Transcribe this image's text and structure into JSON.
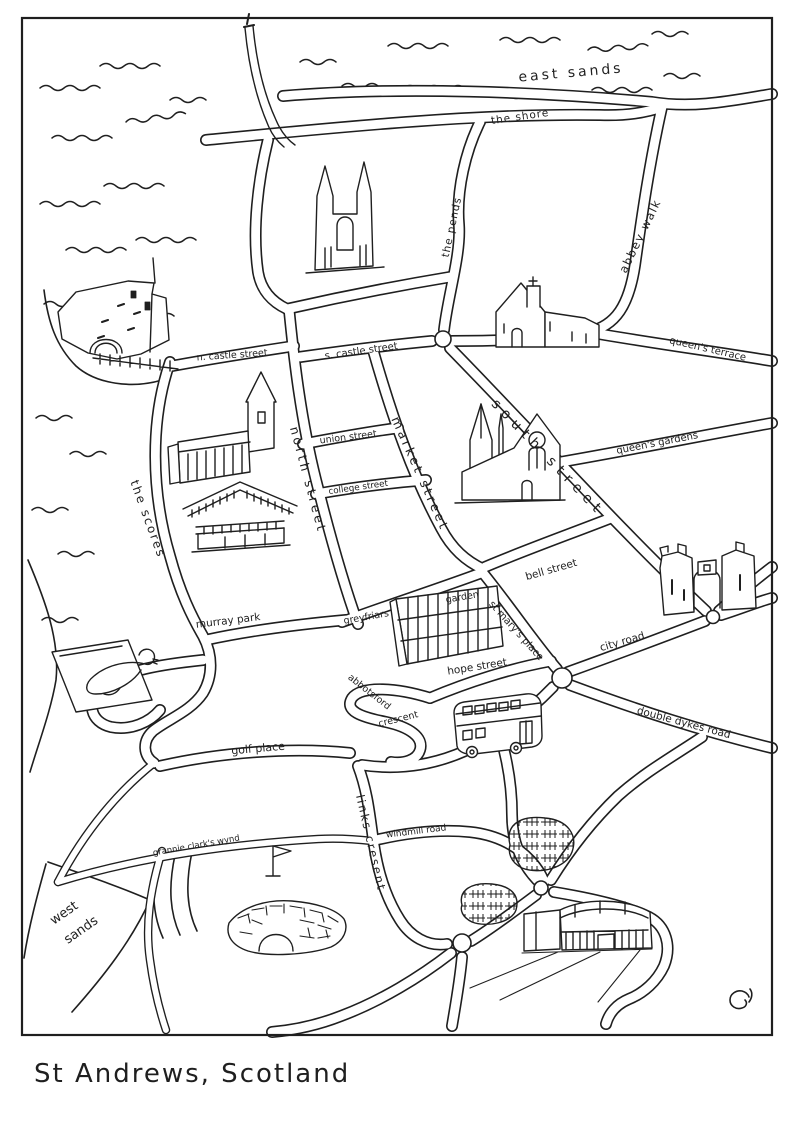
{
  "title": "St Andrews, Scotland",
  "colors": {
    "ink": "#1f1f1f",
    "paper": "#ffffff"
  },
  "map": {
    "water_labels": {
      "east_sands": "east sands",
      "west_sands_word1": "west",
      "west_sands_word2": "sands"
    },
    "streets": {
      "the_shore": "the shore",
      "the_pends": "the pends",
      "abbey_walk": "abbey walk",
      "queens_terrace": "queen's terrace",
      "n_castle_street": "n. castle street",
      "s_castle_street": "s. castle street",
      "south_street": "south street",
      "union_street": "union street",
      "market_street": "market street",
      "north_street": "north street",
      "college_street": "college street",
      "queens_gardens": "queen's gardens",
      "the_scores": "the scores",
      "bell_street": "bell street",
      "murray_park": "murray park",
      "greyfriars_word1": "greyfriars",
      "greyfriars_word2": "garden",
      "st_marys_place": "st mary's place",
      "city_road": "city road",
      "hope_street": "hope street",
      "abbotsford_word1": "abbotsford",
      "abbotsford_word2": "crescent",
      "double_dykes_road": "double dykes road",
      "golf_place": "golf place",
      "grannie_clarks_wynd": "grannie clark's wynd",
      "links_cresent": "links cresent",
      "windmill_road": "windmill road"
    },
    "landmark_icons": [
      "harbour-pier-icon",
      "cathedral-ruins-icon",
      "castle-ruins-icon",
      "chapel-icon",
      "st-salvators-chapel-icon",
      "library-building-icon",
      "holy-trinity-church-icon",
      "glass-building-icon",
      "west-port-arch-icon",
      "double-decker-bus-icon",
      "seal-icon",
      "golf-flag-icon",
      "swilcan-bridge-icon",
      "leisure-building-icon",
      "caravan-hatching-icon",
      "sea-waves-icon",
      "artist-signature-icon"
    ]
  }
}
